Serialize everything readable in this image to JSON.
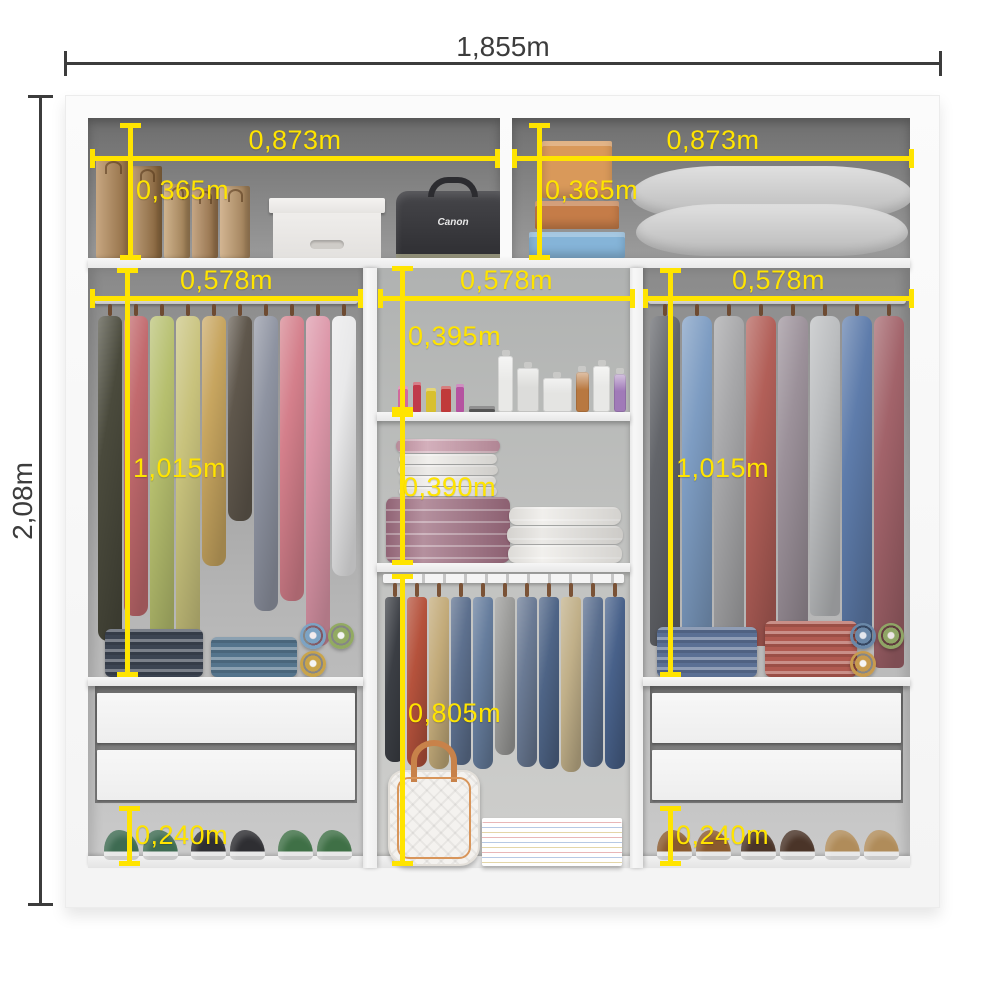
{
  "title": "Wardrobe interior dimensions diagram",
  "colors": {
    "dimension_yellow": "#ffe400",
    "dimension_dark": "#3c3c3c",
    "frame_white": "#fbfbfb",
    "top_compartment_gray": "#6d6d6d",
    "side_column_gray": "#a9a9a9",
    "middle_column_gray": "#b7b9b8"
  },
  "dimensions": {
    "overall_width": "1,855m",
    "overall_height": "2,08m",
    "top_shelf_left_width": "0,873m",
    "top_shelf_right_width": "0,873m",
    "top_shelf_left_height": "0,365m",
    "top_shelf_right_height": "0,365m",
    "left_column_width": "0,578m",
    "middle_column_width": "0,578m",
    "right_column_width": "0,578m",
    "left_hanging_height": "1,015m",
    "right_hanging_height": "1,015m",
    "middle_upper_compartment_height": "0,395m",
    "middle_middle_compartment_height": "0,390m",
    "middle_hanging_height": "0,805m",
    "left_bottom_space_height": "0,240m",
    "right_bottom_space_height": "0,240m"
  },
  "contents": {
    "camera_bag_label": "Canon",
    "paper_bags": [
      {
        "c": "#b58a58",
        "w": 34,
        "h": 100
      },
      {
        "c": "#a57c4c",
        "w": 30,
        "h": 92
      },
      {
        "c": "#c09a68",
        "w": 26,
        "h": 74
      },
      {
        "c": "#b2885a",
        "w": 26,
        "h": 70
      },
      {
        "c": "#c49d6e",
        "w": 30,
        "h": 72
      }
    ],
    "top_right_boxes": [
      {
        "c": "#d9995a",
        "w": 70,
        "h": 58
      },
      {
        "c": "#c57c48",
        "w": 84,
        "h": 28
      },
      {
        "c": "#85b4d8",
        "w": 96,
        "h": 26
      }
    ],
    "pillows": [
      {
        "c": "#d6d6d6",
        "w": 282,
        "h": 54
      },
      {
        "c": "#c8c8c8",
        "w": 272,
        "h": 52
      }
    ],
    "left_hanging": [
      {
        "c": "#4a4a3c",
        "h": 325
      },
      {
        "c": "#c26a6e",
        "h": 300
      },
      {
        "c": "#b6bf6e",
        "h": 340
      },
      {
        "c": "#c8c27c",
        "h": 350
      },
      {
        "c": "#c7a55f",
        "h": 250
      },
      {
        "c": "#5f574c",
        "h": 205
      },
      {
        "c": "#8e93a1",
        "h": 295
      },
      {
        "c": "#d47f8b",
        "h": 285
      },
      {
        "c": "#dc96a8",
        "h": 330
      },
      {
        "c": "#e9e9ea",
        "h": 260
      }
    ],
    "right_hanging": [
      {
        "c": "#63656a",
        "h": 330
      },
      {
        "c": "#7d9cc2",
        "h": 350
      },
      {
        "c": "#a6a6a8",
        "h": 360
      },
      {
        "c": "#b25f58",
        "h": 330
      },
      {
        "c": "#9b9099",
        "h": 345
      },
      {
        "c": "#bcbec0",
        "h": 300
      },
      {
        "c": "#5e7cab",
        "h": 330
      },
      {
        "c": "#a2636a",
        "h": 352
      }
    ],
    "middle_pants": [
      {
        "c": "#3b3e44",
        "h": 165
      },
      {
        "c": "#b5523c",
        "h": 170
      },
      {
        "c": "#c3ab7a",
        "h": 172
      },
      {
        "c": "#5d708e",
        "h": 168
      },
      {
        "c": "#667d9d",
        "h": 172
      },
      {
        "c": "#9b9b99",
        "h": 158
      },
      {
        "c": "#6a7a94",
        "h": 170
      },
      {
        "c": "#4e6486",
        "h": 172
      },
      {
        "c": "#c1b089",
        "h": 175
      },
      {
        "c": "#5a6e8e",
        "h": 170
      },
      {
        "c": "#48618a",
        "h": 172
      }
    ],
    "left_folded_stacks": [
      {
        "c": "#3c4452",
        "w": 98,
        "h": 48
      },
      {
        "c": "#54748c",
        "w": 86,
        "h": 40
      }
    ],
    "left_rolls": [
      {
        "c": "#7ca3c4"
      },
      {
        "c": "#92aa62"
      },
      {
        "c": "#c9a44a"
      }
    ],
    "right_folded_stacks": [
      {
        "c": "#5b7094",
        "w": 100,
        "h": 50
      },
      {
        "c": "#b05a50",
        "w": 92,
        "h": 56
      }
    ],
    "right_rolls": [
      {
        "c": "#6a88a8"
      },
      {
        "c": "#8fa565"
      },
      {
        "c": "#c89b4e"
      }
    ],
    "left_shoes": [
      {
        "c": "#3e6b52"
      },
      {
        "c": "#2e2e32"
      },
      {
        "c": "#3f7046"
      }
    ],
    "right_shoes": [
      {
        "c": "#8a5a2e"
      },
      {
        "c": "#4a3428"
      },
      {
        "c": "#b08c5a"
      }
    ],
    "cosmetics": [
      {
        "c": "#d06a9c",
        "w": 10,
        "h": 26
      },
      {
        "c": "#c03a4a",
        "w": 8,
        "h": 30
      },
      {
        "c": "#d8c030",
        "w": 10,
        "h": 24
      },
      {
        "c": "#c03a3a",
        "w": 10,
        "h": 26
      },
      {
        "c": "#b553a0",
        "w": 8,
        "h": 28
      },
      {
        "c": "#555555",
        "w": 26,
        "h": 6
      }
    ],
    "perfumes": [
      {
        "c": "#e9e9e7",
        "w": 16,
        "h": 56
      },
      {
        "c": "#dcdcda",
        "w": 22,
        "h": 44
      },
      {
        "c": "#e4e4e2",
        "w": 30,
        "h": 34
      },
      {
        "c": "#b87840",
        "w": 14,
        "h": 40
      },
      {
        "c": "#e8e8e6",
        "w": 18,
        "h": 46
      },
      {
        "c": "#a07ab8",
        "w": 12,
        "h": 38
      }
    ],
    "left_towels": [
      {
        "c": "#c595a5",
        "w": 104,
        "h": 16
      },
      {
        "c": "#eceae6",
        "w": 98,
        "h": 11
      },
      {
        "c": "#e6e4e0",
        "w": 100,
        "h": 11
      },
      {
        "c": "#efede9",
        "w": 96,
        "h": 11
      },
      {
        "c": "#e8e6e2",
        "w": 98,
        "h": 11
      },
      {
        "c": "#9c6b7e",
        "w": 124,
        "h": 74
      }
    ],
    "right_towels": [
      {
        "c": "#eceae6",
        "w": 112,
        "h": 18
      },
      {
        "c": "#e4e2de",
        "w": 116,
        "h": 18
      },
      {
        "c": "#edebe7",
        "w": 114,
        "h": 18
      }
    ]
  }
}
